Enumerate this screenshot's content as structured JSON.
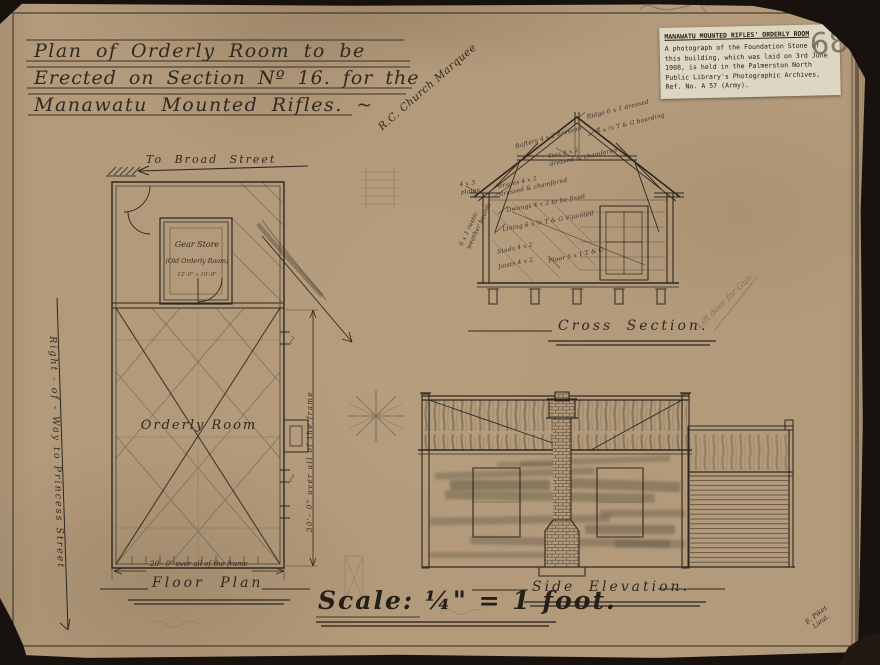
{
  "colors": {
    "paper": "#b39a7a",
    "ink": "#2e2820",
    "pencil": "#756a5b",
    "label_bg": "#ddd6c2",
    "mat": "#17120e"
  },
  "page_number": "68",
  "title": {
    "lines": [
      "Plan of Orderly Room to be",
      "Erected on Section Nº 16. for the",
      "Manawatu Mounted Rifles. ~"
    ]
  },
  "archive_label": {
    "title": "MANAWATU MOUNTED RIFLES' ORDERLY ROOM",
    "body": "A photograph of the Foundation Stone of this building, which was laid on 3rd June 1908, is held in the Palmerston North Public Library's Photographic Archives, Ref. No. A 57 (Army)."
  },
  "annotations": {
    "church_note": "R.C. Church Marquee",
    "gun_note": "Lift door for Gun",
    "signature": "E. Piket\nLieut."
  },
  "floor_plan": {
    "street_label": "To Broad Street",
    "right_of_way": "Right - of - Way  to  Princess  Street",
    "gear_store": "Gear Store",
    "gear_store_sub": "(Old Orderly Room)",
    "gear_store_dim": "12'-0\" x 10'-0\"",
    "room_label": "Orderly Room",
    "dim_bottom": "20'- 0\" over all of the frame",
    "dim_right": "30'- 0\" over all of the frame",
    "caption": "Floor Plan"
  },
  "cross_section": {
    "caption": "Cross Section.",
    "notes": [
      "Ridge 6 x 1 dressed",
      "6 x ⅝ T & G boarding",
      "Rafters 4 x 2 dressed",
      "Ties 4 x 2\ndressed & chamfered",
      "Braces 4 x 2\ndressed & chamfered",
      "Dwangs 4 x 2 to be fixed",
      "Lining 6 x ¾ T & G V-jointed",
      "Studs 4 x 2",
      "Joists 4 x 2",
      "Floor 6 x 1 T & G",
      "4 x 3\nplates",
      "6 x 1 rustic\nweather boards"
    ]
  },
  "side_elevation": {
    "caption": "Side Elevation."
  },
  "scale_note": "Scale: ¼\" = 1 foot."
}
